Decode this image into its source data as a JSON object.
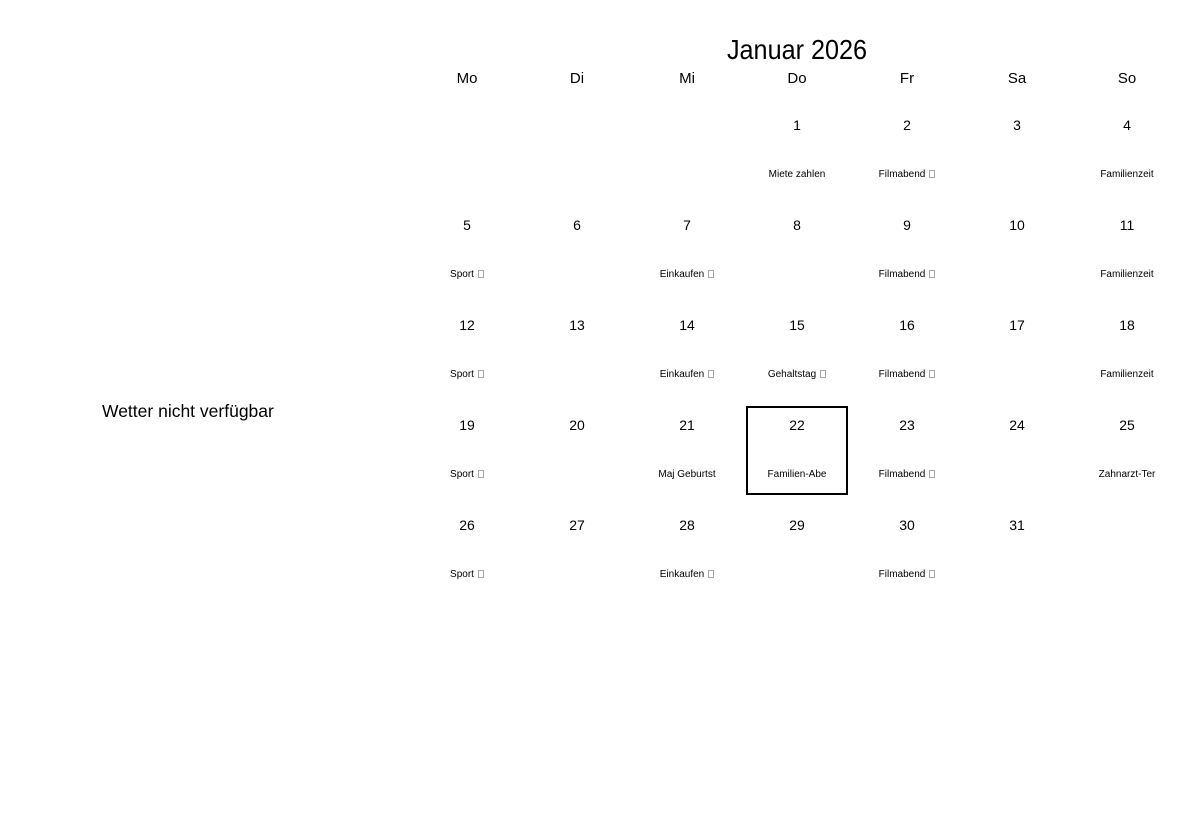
{
  "page": {
    "background_color": "#ffffff",
    "text_color": "#000000",
    "selected_outline_color": "#000000",
    "missing_glyph_color": "#a6a6a6"
  },
  "weather_notice": "Wetter nicht verfügbar",
  "calendar": {
    "title": "Januar 2026",
    "day_headers": [
      "Mo",
      "Di",
      "Mi",
      "Do",
      "Fr",
      "Sa",
      "So"
    ],
    "selected_date": "22",
    "weeks": [
      {
        "days": [
          {
            "date": "",
            "event": "",
            "event_box": false,
            "selected": false
          },
          {
            "date": "",
            "event": "",
            "event_box": false,
            "selected": false
          },
          {
            "date": "",
            "event": "",
            "event_box": false,
            "selected": false
          },
          {
            "date": "1",
            "event": "Miete zahlen",
            "event_box": false,
            "selected": false
          },
          {
            "date": "2",
            "event": "Filmabend",
            "event_box": true,
            "selected": false
          },
          {
            "date": "3",
            "event": "",
            "event_box": false,
            "selected": false
          },
          {
            "date": "4",
            "event": "Familienzeit",
            "event_box": false,
            "selected": false
          }
        ]
      },
      {
        "days": [
          {
            "date": "5",
            "event": "Sport",
            "event_box": true,
            "selected": false
          },
          {
            "date": "6",
            "event": "",
            "event_box": false,
            "selected": false
          },
          {
            "date": "7",
            "event": "Einkaufen",
            "event_box": true,
            "selected": false
          },
          {
            "date": "8",
            "event": "",
            "event_box": false,
            "selected": false
          },
          {
            "date": "9",
            "event": "Filmabend",
            "event_box": true,
            "selected": false
          },
          {
            "date": "10",
            "event": "",
            "event_box": false,
            "selected": false
          },
          {
            "date": "11",
            "event": "Familienzeit",
            "event_box": false,
            "selected": false
          }
        ]
      },
      {
        "days": [
          {
            "date": "12",
            "event": "Sport",
            "event_box": true,
            "selected": false
          },
          {
            "date": "13",
            "event": "",
            "event_box": false,
            "selected": false
          },
          {
            "date": "14",
            "event": "Einkaufen",
            "event_box": true,
            "selected": false
          },
          {
            "date": "15",
            "event": "Gehaltstag",
            "event_box": true,
            "selected": false
          },
          {
            "date": "16",
            "event": "Filmabend",
            "event_box": true,
            "selected": false
          },
          {
            "date": "17",
            "event": "",
            "event_box": false,
            "selected": false
          },
          {
            "date": "18",
            "event": "Familienzeit",
            "event_box": false,
            "selected": false
          }
        ]
      },
      {
        "days": [
          {
            "date": "19",
            "event": "Sport",
            "event_box": true,
            "selected": false
          },
          {
            "date": "20",
            "event": "",
            "event_box": false,
            "selected": false
          },
          {
            "date": "21",
            "event": "Maj Geburtst",
            "event_box": false,
            "selected": false
          },
          {
            "date": "22",
            "event": "Familien-Abe",
            "event_box": false,
            "selected": true
          },
          {
            "date": "23",
            "event": "Filmabend",
            "event_box": true,
            "selected": false
          },
          {
            "date": "24",
            "event": "",
            "event_box": false,
            "selected": false
          },
          {
            "date": "25",
            "event": "Zahnarzt-Ter",
            "event_box": false,
            "selected": false
          }
        ]
      },
      {
        "days": [
          {
            "date": "26",
            "event": "Sport",
            "event_box": true,
            "selected": false
          },
          {
            "date": "27",
            "event": "",
            "event_box": false,
            "selected": false
          },
          {
            "date": "28",
            "event": "Einkaufen",
            "event_box": true,
            "selected": false
          },
          {
            "date": "29",
            "event": "",
            "event_box": false,
            "selected": false
          },
          {
            "date": "30",
            "event": "Filmabend",
            "event_box": true,
            "selected": false
          },
          {
            "date": "31",
            "event": "",
            "event_box": false,
            "selected": false
          },
          {
            "date": "",
            "event": "",
            "event_box": false,
            "selected": false
          }
        ]
      }
    ]
  }
}
